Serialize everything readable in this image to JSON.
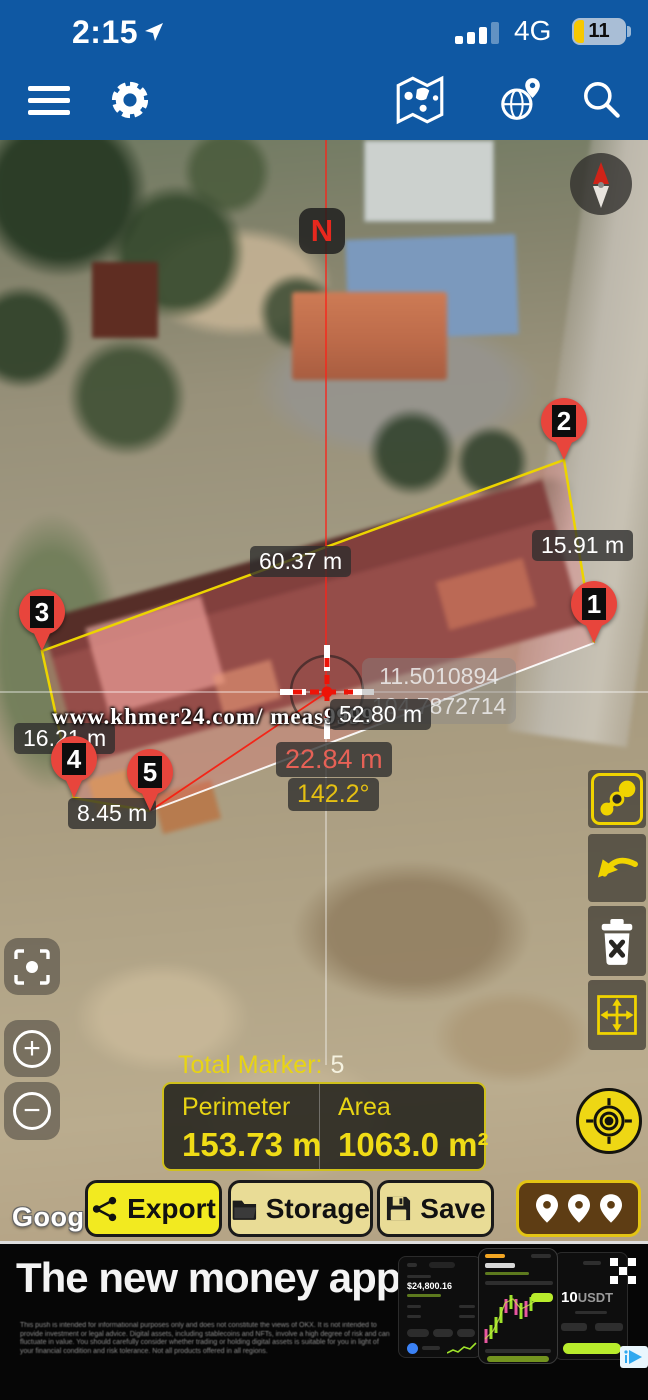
{
  "status_bar": {
    "time": "2:15",
    "network": "4G",
    "battery": "11"
  },
  "map": {
    "north_badge": "N",
    "markers": [
      "1",
      "2",
      "3",
      "4",
      "5"
    ],
    "edges": {
      "e12": "15.91 m",
      "e23": "60.37 m",
      "e34": "16.21 m",
      "e45": "8.45 m",
      "e51": "52.80 m"
    },
    "gps": {
      "lat": "11.5010894",
      "lng": "104.7872714",
      "distance": "22.84 m",
      "bearing": "142.2°"
    },
    "watermark": "www.khmer24.com/ meas9999",
    "google": "Google"
  },
  "results": {
    "total_label": "Total Marker:",
    "total_value": "5",
    "perimeter_label": "Perimeter",
    "perimeter_value": "153.73 m",
    "area_label": "Area",
    "area_value": "1063.0 m²"
  },
  "actions": {
    "export": "Export",
    "storage": "Storage",
    "save": "Save"
  },
  "ad": {
    "headline": "The new money app.",
    "disclaimer": "This push is intended for informational purposes only and does not constitute the views of OKX. It is not intended to provide investment or legal advice. Digital assets, including stablecoins and NFTs, involve a high degree of risk and can fluctuate in value. You should carefully consider whether trading or holding digital assets is suitable for you in light of your financial condition and risk tolerance. Not all products offered in all regions.",
    "amount": "10",
    "amount_unit": "USDT",
    "balance": "$24,800.16"
  },
  "colors": {
    "header_blue": "#0f58a3",
    "accent_yellow": "#f0d400",
    "marker_red": "#e8453c",
    "panel_yellow_text": "#e8d414"
  }
}
